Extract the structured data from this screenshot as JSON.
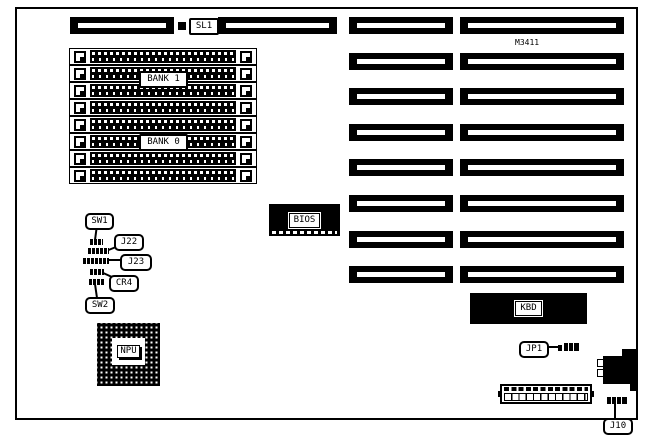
{
  "board": {
    "model": "M3411"
  },
  "labels": {
    "model": "M3411",
    "sl1": "SL1",
    "bank1": "BANK 1",
    "bank0": "BANK 0",
    "bios": "BIOS",
    "npu": "NPU",
    "kbd": "KBD",
    "jp1": "JP1",
    "j10": "J10",
    "sw1": "SW1",
    "sw2": "SW2",
    "j22": "J22",
    "j23": "J23",
    "cr4": "CR4"
  },
  "memory": {
    "socket_count": 8,
    "banks": [
      {
        "label": "BANK 1"
      },
      {
        "label": "BANK 0"
      }
    ]
  },
  "expansion": {
    "row_count": 8
  },
  "colors": {
    "ink": "#000000",
    "paper": "#ffffff"
  }
}
